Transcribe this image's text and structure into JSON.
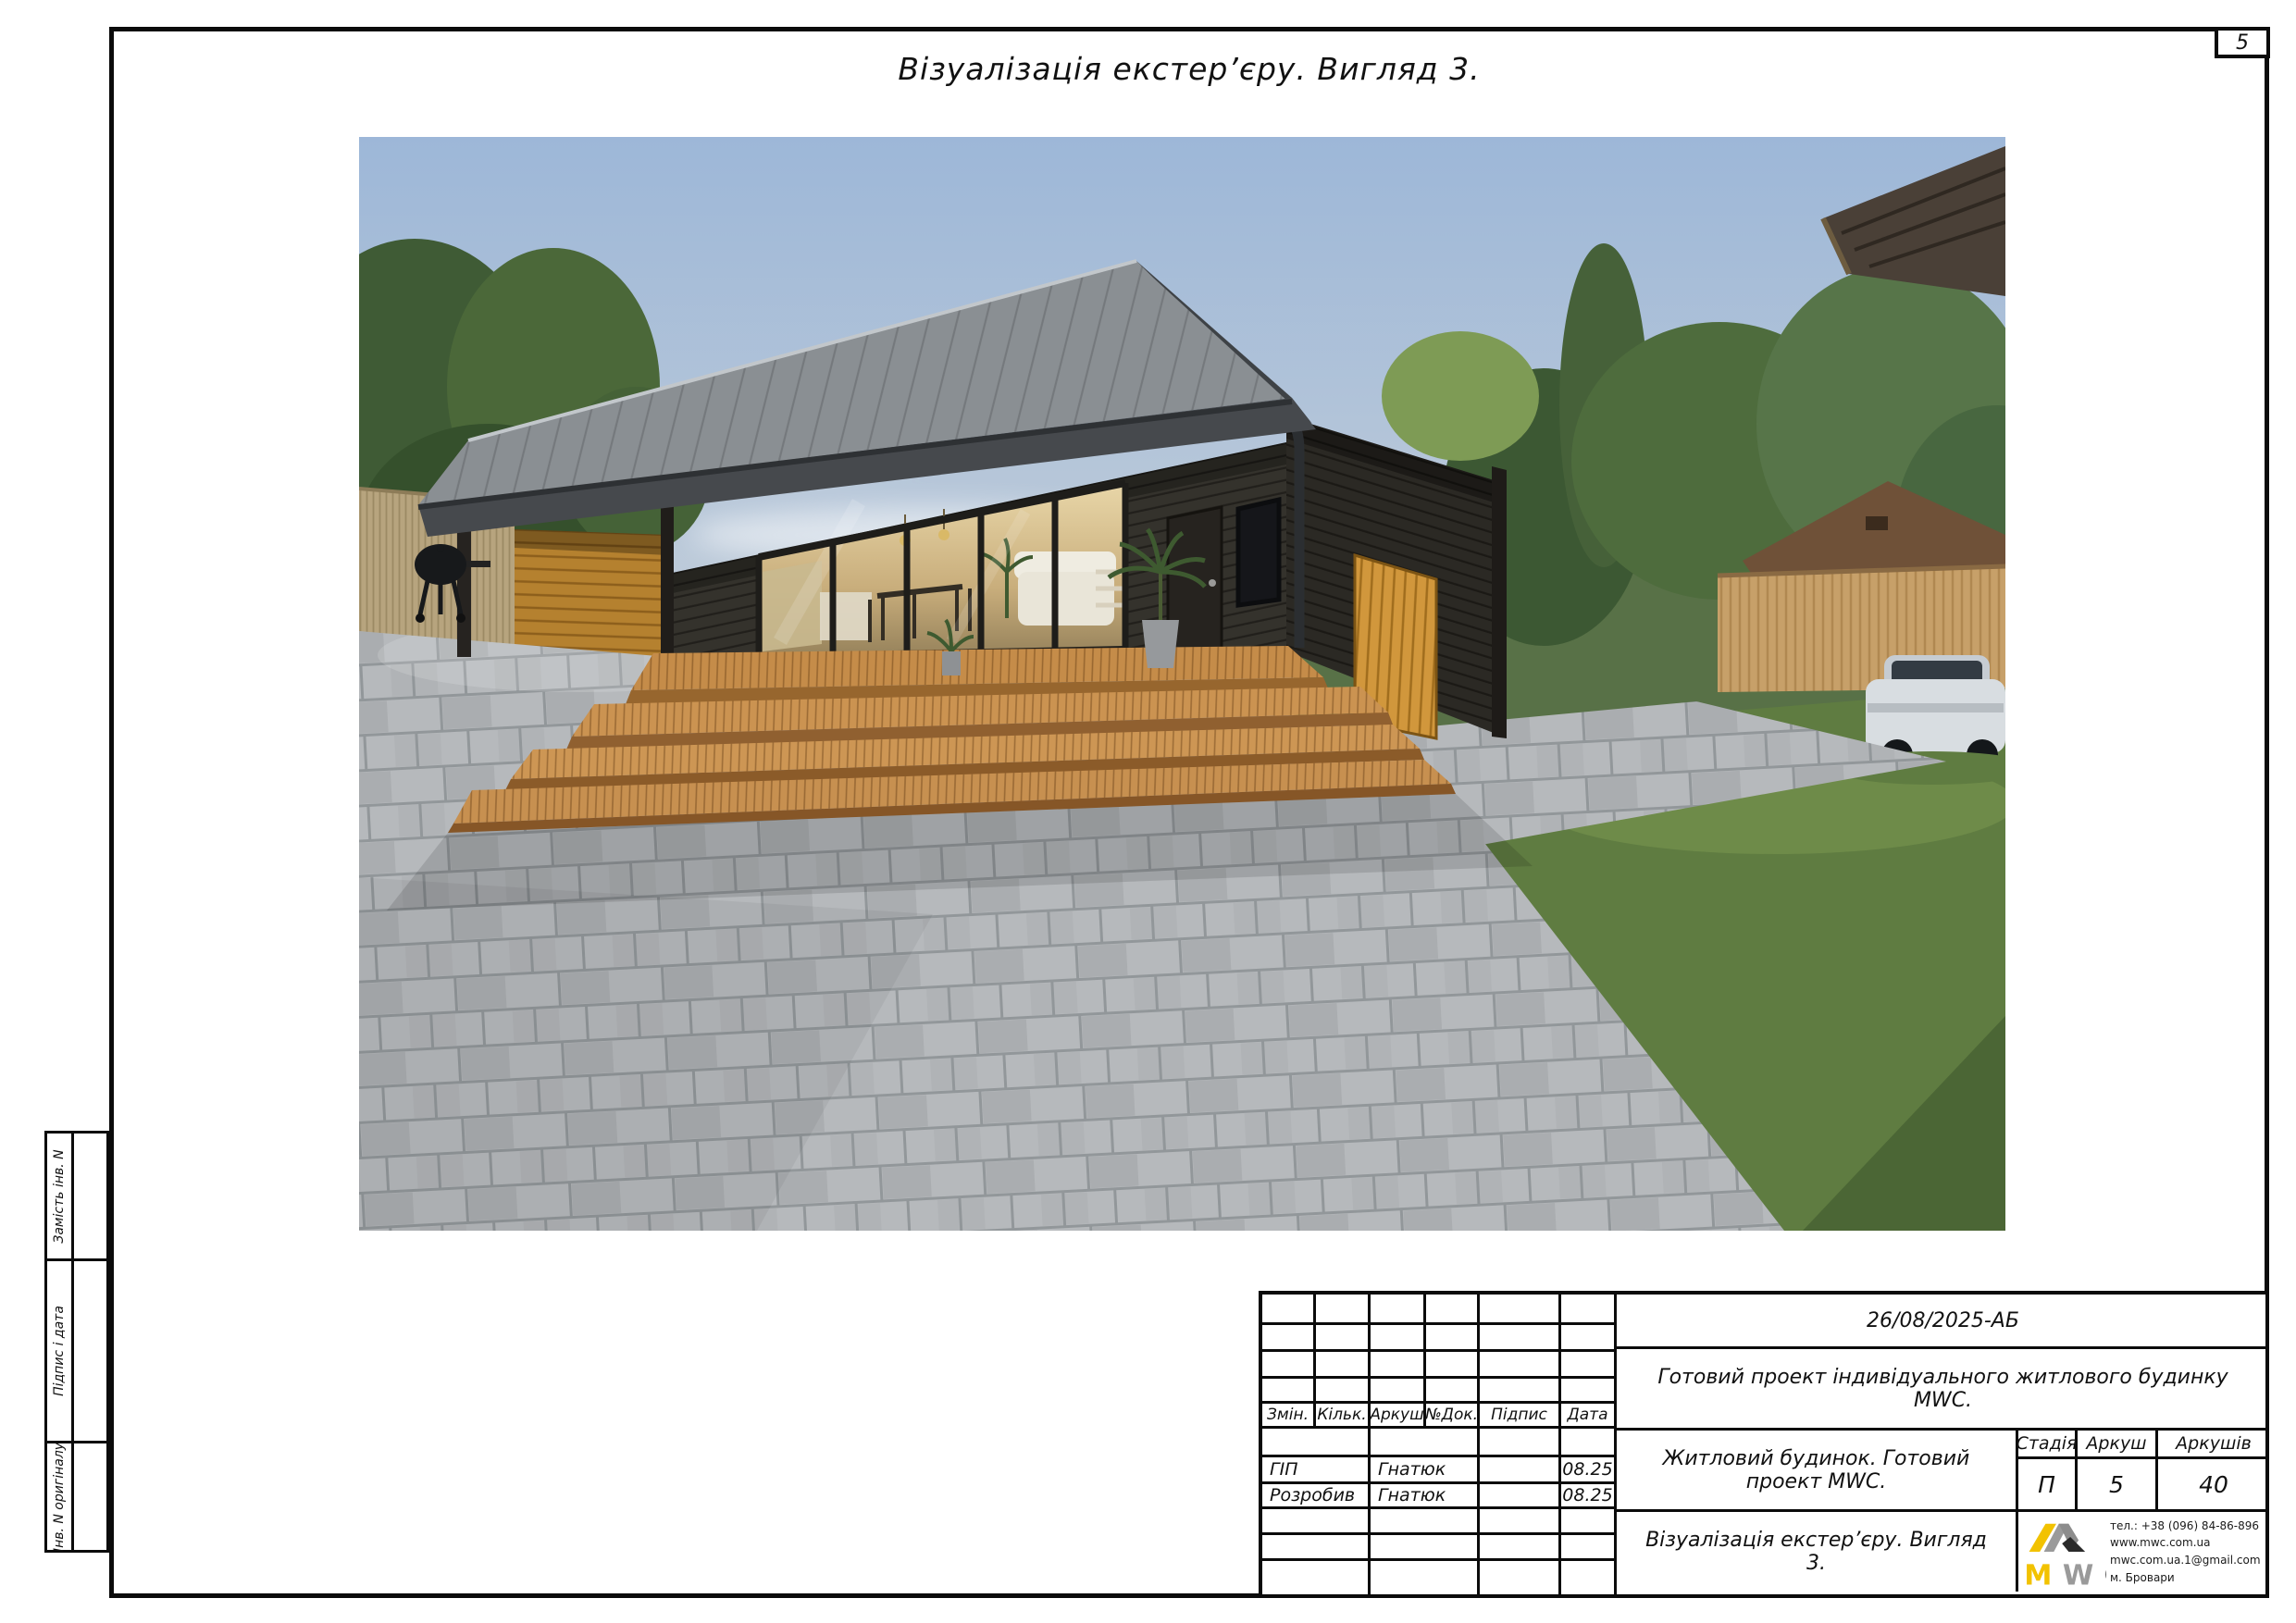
{
  "page": {
    "sheet_number": "5",
    "title": "Візуалізація екстер’єру. Вигляд 3."
  },
  "side_columns": {
    "labels": [
      "Замість інв. N",
      "Підпис і дата",
      "Інв. N оригіналу"
    ]
  },
  "title_block": {
    "doc_code": "26/08/2025-АБ",
    "project_name": "Готовий проект індивідуального житлового будинку MWC.",
    "object_name": "Житловий будинок. Готовий проект MWC.",
    "drawing_name": "Візуалізація екстер’єру. Вигляд 3.",
    "header_columns": [
      "Змін.",
      "Кільк.",
      "Аркуш",
      "№Док.",
      "Підпис",
      "Дата"
    ],
    "signature_rows": [
      {
        "role": "ГІП",
        "name": "Гнатюк",
        "signature": "",
        "date": "08.25"
      },
      {
        "role": "Розробив",
        "name": "Гнатюк",
        "signature": "",
        "date": "08.25"
      }
    ],
    "stage_table": {
      "headers": [
        "Стадія",
        "Аркуш",
        "Аркушів"
      ],
      "values": [
        "П",
        "5",
        "40"
      ]
    },
    "company": {
      "logo_letters": [
        "M",
        "W",
        "C"
      ],
      "phone": "тел.: +38 (096) 84-86-896",
      "website": "www.mwc.com.ua",
      "email": "mwc.com.ua.1@gmail.com",
      "city": "м. Бровари",
      "colors": {
        "yellow": "#f2c200",
        "gray": "#9a9a9a",
        "black": "#2a2a2a"
      }
    }
  }
}
